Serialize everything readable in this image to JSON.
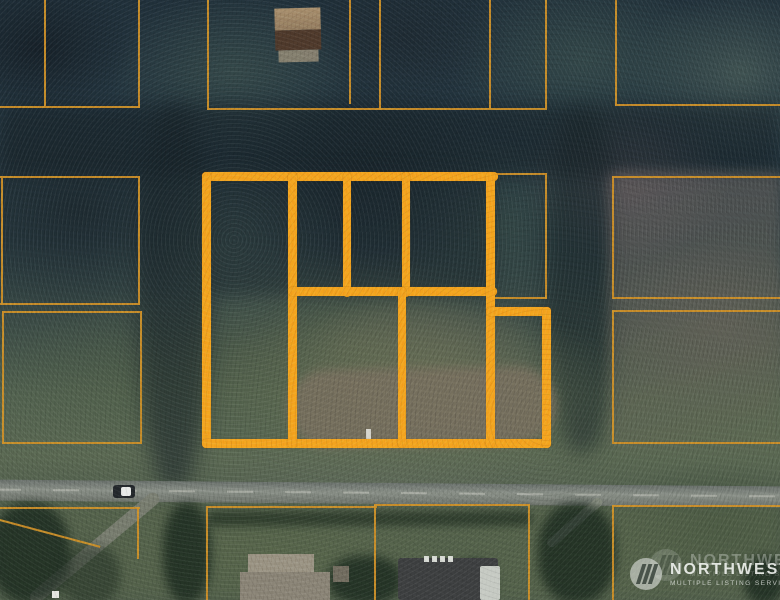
{
  "image": {
    "width": 780,
    "height": 600,
    "kind": "aerial-parcel-photo"
  },
  "watermark": {
    "brand": "NORTHWEST",
    "subtitle": "MULTIPLE LISTING SERVICE.",
    "logo": "pine-trees-circle-icon"
  },
  "colors": {
    "subject_outline": "#F3A41E",
    "parcel_line": "#CD9028",
    "road": "#7d837c",
    "forest_dark": "#24333a",
    "clearing_green": "#5e6b50",
    "clearing_dirt": "#79705f"
  },
  "overlay": {
    "thick_segments": [
      {
        "x": 202,
        "y": 172,
        "w": 296,
        "h": 9
      },
      {
        "x": 202,
        "y": 172,
        "w": 9,
        "h": 276
      },
      {
        "x": 202,
        "y": 439,
        "w": 349,
        "h": 9
      },
      {
        "x": 288,
        "y": 172,
        "w": 9,
        "h": 276
      },
      {
        "x": 343,
        "y": 172,
        "w": 8,
        "h": 125
      },
      {
        "x": 402,
        "y": 172,
        "w": 8,
        "h": 125
      },
      {
        "x": 288,
        "y": 287,
        "w": 209,
        "h": 9
      },
      {
        "x": 486,
        "y": 172,
        "w": 9,
        "h": 276
      },
      {
        "x": 398,
        "y": 287,
        "w": 8,
        "h": 161
      },
      {
        "x": 486,
        "y": 307,
        "w": 65,
        "h": 9
      },
      {
        "x": 542,
        "y": 307,
        "w": 9,
        "h": 141
      }
    ],
    "thin_segments": [
      {
        "x": 44,
        "y": 0,
        "w": 2,
        "h": 108
      },
      {
        "x": 138,
        "y": 0,
        "w": 2,
        "h": 108
      },
      {
        "x": 0,
        "y": 106,
        "w": 140,
        "h": 2
      },
      {
        "x": 207,
        "y": 0,
        "w": 2,
        "h": 110
      },
      {
        "x": 349,
        "y": 0,
        "w": 2,
        "h": 104
      },
      {
        "x": 379,
        "y": 0,
        "w": 2,
        "h": 110
      },
      {
        "x": 489,
        "y": 0,
        "w": 2,
        "h": 108
      },
      {
        "x": 545,
        "y": 0,
        "w": 2,
        "h": 108
      },
      {
        "x": 207,
        "y": 108,
        "w": 340,
        "h": 2
      },
      {
        "x": 615,
        "y": 0,
        "w": 2,
        "h": 105
      },
      {
        "x": 615,
        "y": 104,
        "w": 165,
        "h": 2
      },
      {
        "x": 0,
        "y": 176,
        "w": 140,
        "h": 2
      },
      {
        "x": 138,
        "y": 176,
        "w": 2,
        "h": 129
      },
      {
        "x": 0,
        "y": 303,
        "w": 140,
        "h": 2
      },
      {
        "x": 1,
        "y": 176,
        "w": 2,
        "h": 129
      },
      {
        "x": 2,
        "y": 311,
        "w": 140,
        "h": 2
      },
      {
        "x": 140,
        "y": 311,
        "w": 2,
        "h": 133
      },
      {
        "x": 2,
        "y": 442,
        "w": 140,
        "h": 2
      },
      {
        "x": 2,
        "y": 311,
        "w": 2,
        "h": 133
      },
      {
        "x": 493,
        "y": 173,
        "w": 54,
        "h": 2
      },
      {
        "x": 545,
        "y": 173,
        "w": 2,
        "h": 126
      },
      {
        "x": 492,
        "y": 297,
        "w": 55,
        "h": 2
      },
      {
        "x": 612,
        "y": 176,
        "w": 168,
        "h": 2
      },
      {
        "x": 612,
        "y": 176,
        "w": 2,
        "h": 123
      },
      {
        "x": 612,
        "y": 297,
        "w": 168,
        "h": 2
      },
      {
        "x": 612,
        "y": 310,
        "w": 168,
        "h": 2
      },
      {
        "x": 612,
        "y": 310,
        "w": 2,
        "h": 134
      },
      {
        "x": 612,
        "y": 442,
        "w": 168,
        "h": 2
      },
      {
        "x": 0,
        "y": 507,
        "w": 140,
        "h": 2
      },
      {
        "x": 137,
        "y": 507,
        "w": 2,
        "h": 52
      },
      {
        "x": 0,
        "y": 519,
        "w": 104,
        "h": 2,
        "rot": 15
      },
      {
        "x": 206,
        "y": 506,
        "w": 171,
        "h": 2
      },
      {
        "x": 206,
        "y": 506,
        "w": 2,
        "h": 94
      },
      {
        "x": 374,
        "y": 504,
        "w": 2,
        "h": 96
      },
      {
        "x": 374,
        "y": 504,
        "w": 156,
        "h": 2
      },
      {
        "x": 528,
        "y": 504,
        "w": 2,
        "h": 96
      },
      {
        "x": 612,
        "y": 505,
        "w": 168,
        "h": 2
      },
      {
        "x": 612,
        "y": 505,
        "w": 2,
        "h": 95
      }
    ]
  }
}
